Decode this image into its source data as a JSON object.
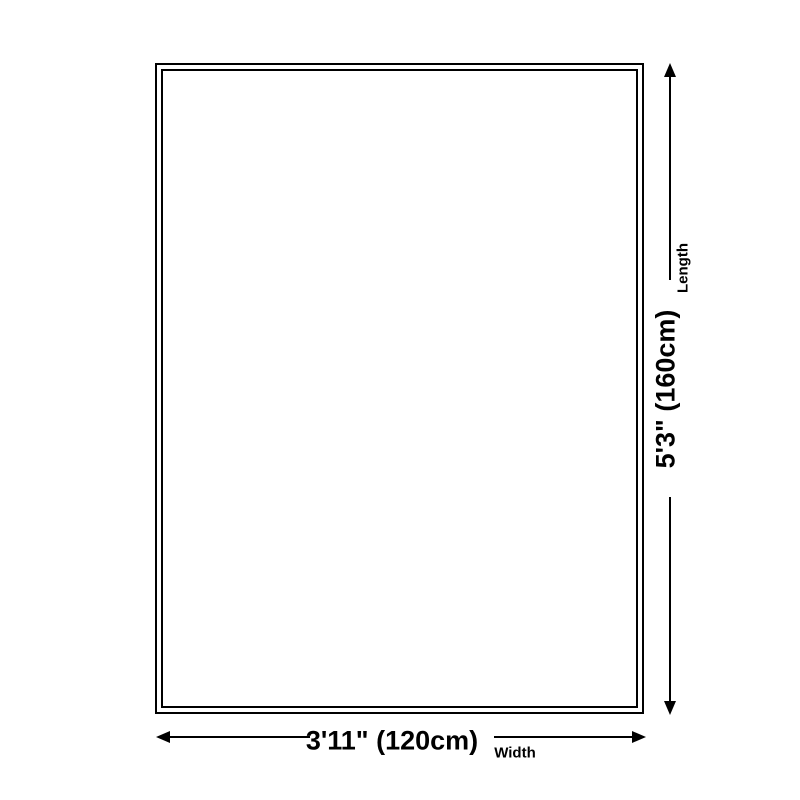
{
  "diagram": {
    "type": "product-dimension-diagram",
    "background_color": "#ffffff",
    "line_color": "#000000",
    "length": {
      "value": "5'3\" (160cm)",
      "label": "Length"
    },
    "width": {
      "value": "3'11\" (120cm)",
      "label": "Width"
    }
  }
}
